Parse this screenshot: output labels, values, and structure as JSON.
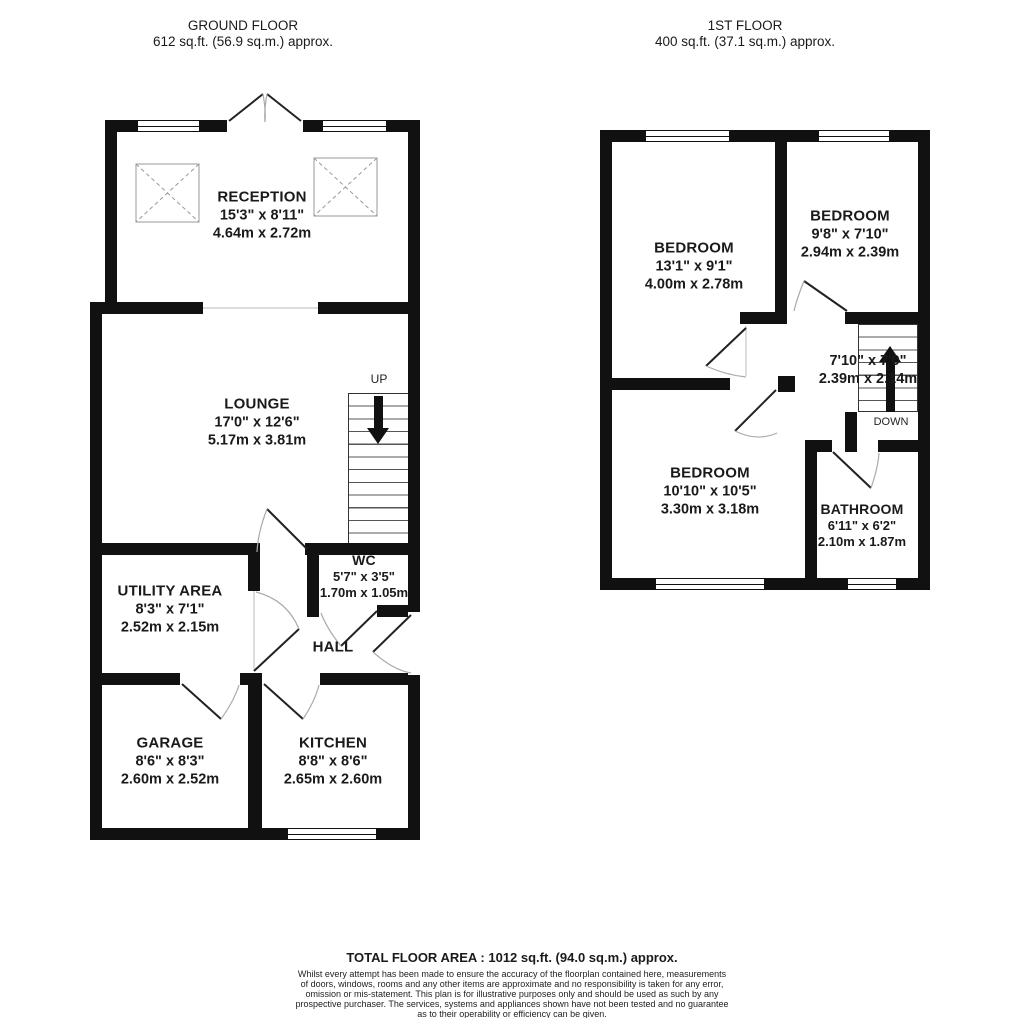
{
  "ground_floor": {
    "title": "GROUND FLOOR",
    "area": "612 sq.ft. (56.9 sq.m.) approx.",
    "stairs_label": "UP",
    "rooms": {
      "reception": {
        "name": "RECEPTION",
        "imperial": "15'3\" x 8'11\"",
        "metric": "4.64m x 2.72m"
      },
      "lounge": {
        "name": "LOUNGE",
        "imperial": "17'0\" x 12'6\"",
        "metric": "5.17m x 3.81m"
      },
      "wc": {
        "name": "WC",
        "imperial": "5'7\" x 3'5\"",
        "metric": "1.70m x 1.05m"
      },
      "utility": {
        "name": "UTILITY AREA",
        "imperial": "8'3\" x 7'1\"",
        "metric": "2.52m x 2.15m"
      },
      "hall": {
        "name": "HALL"
      },
      "garage": {
        "name": "GARAGE",
        "imperial": "8'6\" x 8'3\"",
        "metric": "2.60m x 2.52m"
      },
      "kitchen": {
        "name": "KITCHEN",
        "imperial": "8'8\" x 8'6\"",
        "metric": "2.65m x 2.60m"
      }
    }
  },
  "first_floor": {
    "title": "1ST FLOOR",
    "area": "400 sq.ft. (37.1 sq.m.) approx.",
    "stairs_label": "DOWN",
    "rooms": {
      "bedroom1": {
        "name": "BEDROOM",
        "imperial": "13'1\" x 9'1\"",
        "metric": "4.00m x 2.78m"
      },
      "bedroom2": {
        "name": "BEDROOM",
        "imperial": "9'8\" x 7'10\"",
        "metric": "2.94m x 2.39m"
      },
      "landing": {
        "imperial": "7'10\" x 7'0\"",
        "metric": "2.39m x 2.14m"
      },
      "bedroom3": {
        "name": "BEDROOM",
        "imperial": "10'10\" x 10'5\"",
        "metric": "3.30m x 3.18m"
      },
      "bathroom": {
        "name": "BATHROOM",
        "imperial": "6'11\" x 6'2\"",
        "metric": "2.10m x 1.87m"
      }
    }
  },
  "footer": {
    "total": "TOTAL FLOOR AREA : 1012 sq.ft. (94.0 sq.m.) approx.",
    "disclaimer_lines": [
      "Whilst every attempt has been made to ensure the accuracy of the floorplan contained here, measurements",
      "of doors, windows, rooms and any other items are approximate and no responsibility is taken for any error,",
      "omission or mis-statement. This plan is for illustrative purposes only and should be used as such by any",
      "prospective purchaser. The services, systems and appliances shown have not been tested and no guarantee",
      "as to their operability or efficiency can be given."
    ],
    "credit": "Made with Metropix ©2026"
  },
  "colors": {
    "wall": "#111111",
    "text": "#1a1a1a",
    "door_arc": "#aaaaaa"
  }
}
